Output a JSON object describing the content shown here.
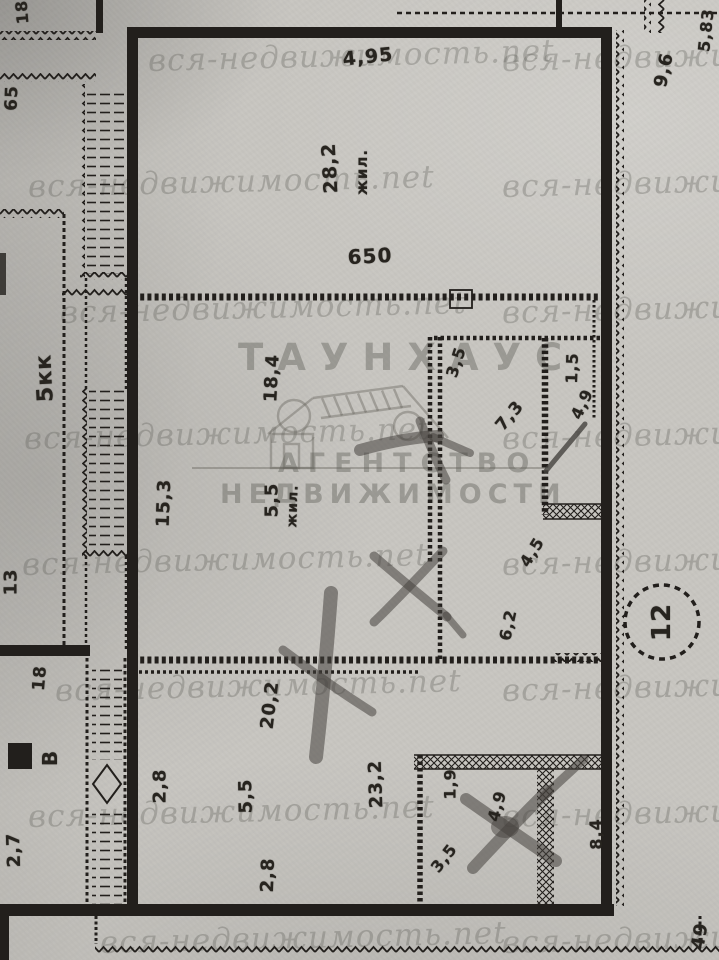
{
  "document_type": "scanned floor plan photo",
  "watermark": {
    "tile_text": "вся-недвижимость.net",
    "logo": {
      "line1": "ТАУНХАУС",
      "line2": "АГЕНТСТВО",
      "line3": "НЕДВИЖИМОСТИ"
    }
  },
  "annotations": {
    "corner_18": "18",
    "left_65": "65",
    "left_5kk": "5кк",
    "left_13": "13",
    "left_18": "18",
    "left_v": "В",
    "left_27": "2,7",
    "top_dim": "4,95",
    "room1_area": "28,2",
    "room1_label": "жил.",
    "room1_width": "650",
    "mid_184": "18,4",
    "mid_35": "3,5",
    "mid_73": "7,3",
    "bath_15": "1,5",
    "bath_49": "4,9",
    "mid_153": "15,3",
    "mid_55": "5,5",
    "mid_zhil": "жил.",
    "mid_45": "4,5",
    "mid_62": "6,2",
    "low_202": "20,2",
    "low_28a": "2,8",
    "low_55": "5,5",
    "low_232": "23,2",
    "low_28b": "2,8",
    "br_19": "1,9",
    "br_35": "3,5",
    "br_49": "4,9",
    "br_84": "8,4",
    "circle_12": "12",
    "tr_96": "9,6",
    "tr_583": "5,83",
    "bb_49": "49"
  },
  "colors": {
    "paper": "#c8c6c1",
    "ink": "#221f1c",
    "watermark_gray": "#605d57",
    "marker_gray": "#45423e"
  }
}
